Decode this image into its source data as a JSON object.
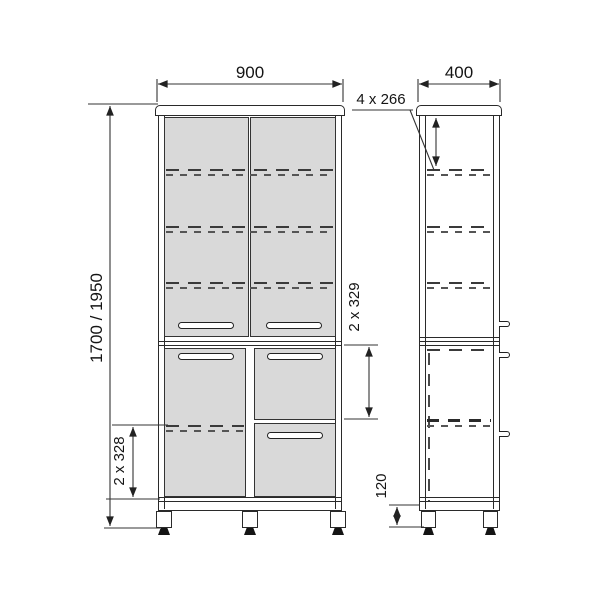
{
  "front_view": {
    "width": "900",
    "height": "1700 / 1950",
    "shelf_spacing_lower": "2 x 328",
    "drawer_heights": "2 x 329"
  },
  "side_view": {
    "depth": "400",
    "shelf_spacing_upper": "4 x 266",
    "leg_height": "120"
  },
  "colors": {
    "outline": "#2a2a2a",
    "door_fill": "#d9d9d9",
    "dimension_line": "#333333",
    "background": "#ffffff"
  }
}
